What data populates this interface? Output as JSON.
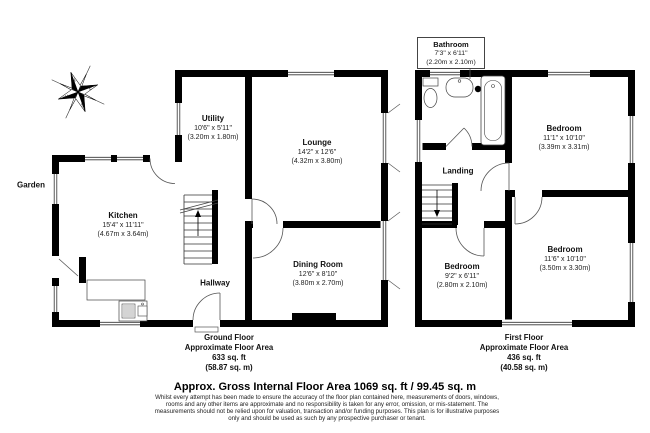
{
  "page": {
    "garden_label": "Garden",
    "gross_area_line": "Approx. Gross Internal Floor Area 1069 sq. ft / 99.45 sq. m",
    "disclaimer": [
      "Whilst every attempt has been made to ensure the accuracy of the floor plan contained here, measurements of doors, windows,",
      "rooms and any other items are approximate and no responsibility is taken for any error, omission, or mis-statement. The",
      "measurements should not be relied upon for valuation, transaction and/or funding purposes. This plan is for illustrative purposes",
      "only and should be used as such by any prospective purchaser or tenant."
    ]
  },
  "compass": {
    "n": "N",
    "e": "E",
    "s": "S",
    "w": "W"
  },
  "ground_floor": {
    "summary": {
      "floor_name": "Ground Floor",
      "area_label": "Approximate Floor Area",
      "area_ft": "633 sq. ft",
      "area_m": "(58.87 sq. m)"
    },
    "rooms": {
      "kitchen": {
        "name": "Kitchen",
        "imperial": "15'4\" x 11'11\"",
        "metric": "(4.67m x 3.64m)"
      },
      "utility": {
        "name": "Utility",
        "imperial": "10'6\" x 5'11\"",
        "metric": "(3.20m x 1.80m)"
      },
      "lounge": {
        "name": "Lounge",
        "imperial": "14'2\" x 12'6\"",
        "metric": "(4.32m x 3.80m)"
      },
      "dining_room": {
        "name": "Dining Room",
        "imperial": "12'6\" x 8'10\"",
        "metric": "(3.80m x 2.70m)"
      },
      "hallway": {
        "name": "Hallway"
      }
    }
  },
  "first_floor": {
    "summary": {
      "floor_name": "First Floor",
      "area_label": "Approximate Floor Area",
      "area_ft": "436 sq. ft",
      "area_m": "(40.58 sq. m)"
    },
    "rooms": {
      "bathroom": {
        "name": "Bathroom",
        "imperial": "7'3\" x 6'11\"",
        "metric": "(2.20m x 2.10m)"
      },
      "bedroom_front": {
        "name": "Bedroom",
        "imperial": "11'1\" x 10'10\"",
        "metric": "(3.39m x 3.31m)"
      },
      "bedroom_back": {
        "name": "Bedroom",
        "imperial": "11'6\" x 10'10\"",
        "metric": "(3.50m x 3.30m)"
      },
      "bedroom_small": {
        "name": "Bedroom",
        "imperial": "9'2\" x 6'11\"",
        "metric": "(2.80m x 2.10m)"
      },
      "landing": {
        "name": "Landing"
      }
    }
  }
}
